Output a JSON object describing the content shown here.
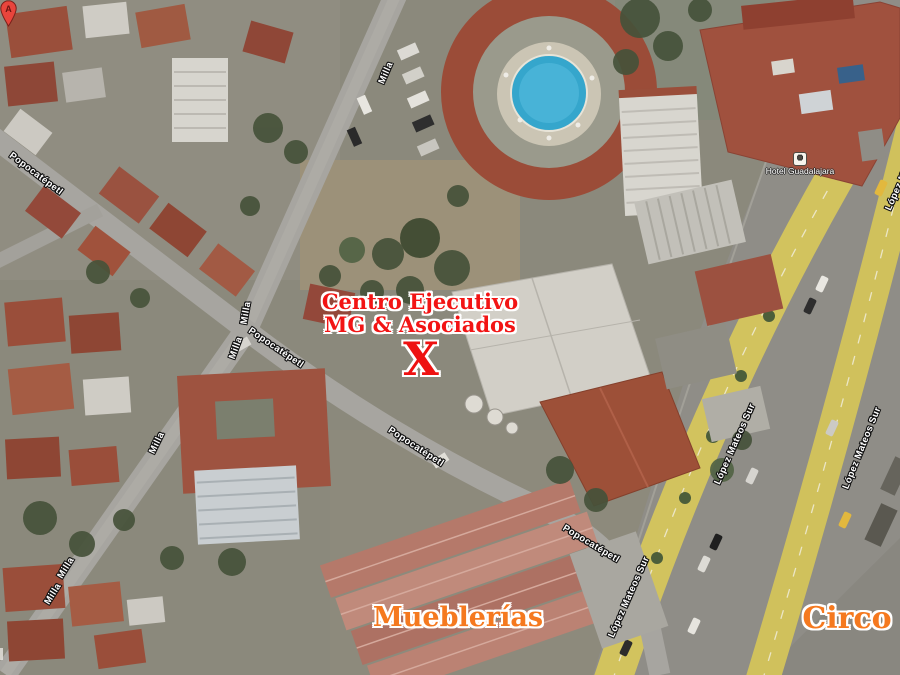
{
  "map": {
    "street_labels": [
      {
        "text": "Milla",
        "x": 386,
        "y": 73,
        "rot": -66
      },
      {
        "text": "Milla",
        "x": 246,
        "y": 313,
        "rot": -80
      },
      {
        "text": "Milla",
        "x": 236,
        "y": 348,
        "rot": -70
      },
      {
        "text": "Milla",
        "x": 157,
        "y": 443,
        "rot": -64
      },
      {
        "text": "Milla",
        "x": 66,
        "y": 568,
        "rot": -58
      },
      {
        "text": "Milla",
        "x": 53,
        "y": 594,
        "rot": -58
      },
      {
        "text": "Popocatépetl",
        "x": 36,
        "y": 174,
        "rot": 37
      },
      {
        "text": "Popocatépetl",
        "x": 276,
        "y": 348,
        "rot": 34
      },
      {
        "text": "Popocatépetl",
        "x": 416,
        "y": 447,
        "rot": 33
      },
      {
        "text": "Popocatépetl",
        "x": 591,
        "y": 544,
        "rot": 31
      },
      {
        "text": "López Mateos Sur",
        "x": 629,
        "y": 597,
        "rot": -66
      },
      {
        "text": "López Mateos Sur",
        "x": 735,
        "y": 444,
        "rot": -66
      },
      {
        "text": "López Mateos Sur",
        "x": 862,
        "y": 448,
        "rot": -68
      },
      {
        "text": "López Mateos Sur",
        "x": 906,
        "y": 170,
        "rot": -66
      }
    ],
    "poi_labels": [
      {
        "icon": "lodging-icon",
        "text": "Hotel Guadalajara"
      }
    ],
    "annotations": {
      "destination": {
        "line1": "Centro Ejecutivo",
        "line2": "MG & Asociados",
        "marker": "X",
        "color": "#f21414"
      },
      "areas": [
        {
          "text": "Mueblerías"
        },
        {
          "text": "Circo"
        }
      ],
      "area_color": "#f5791f"
    },
    "pin": {
      "letter": "A",
      "color": "#e8453c"
    },
    "colors": {
      "highway_yellow": "#d2c35e",
      "road_gray": "#a7a5a0",
      "roof_red": "#9c513c",
      "pool_blue": "#35a6cc"
    }
  }
}
